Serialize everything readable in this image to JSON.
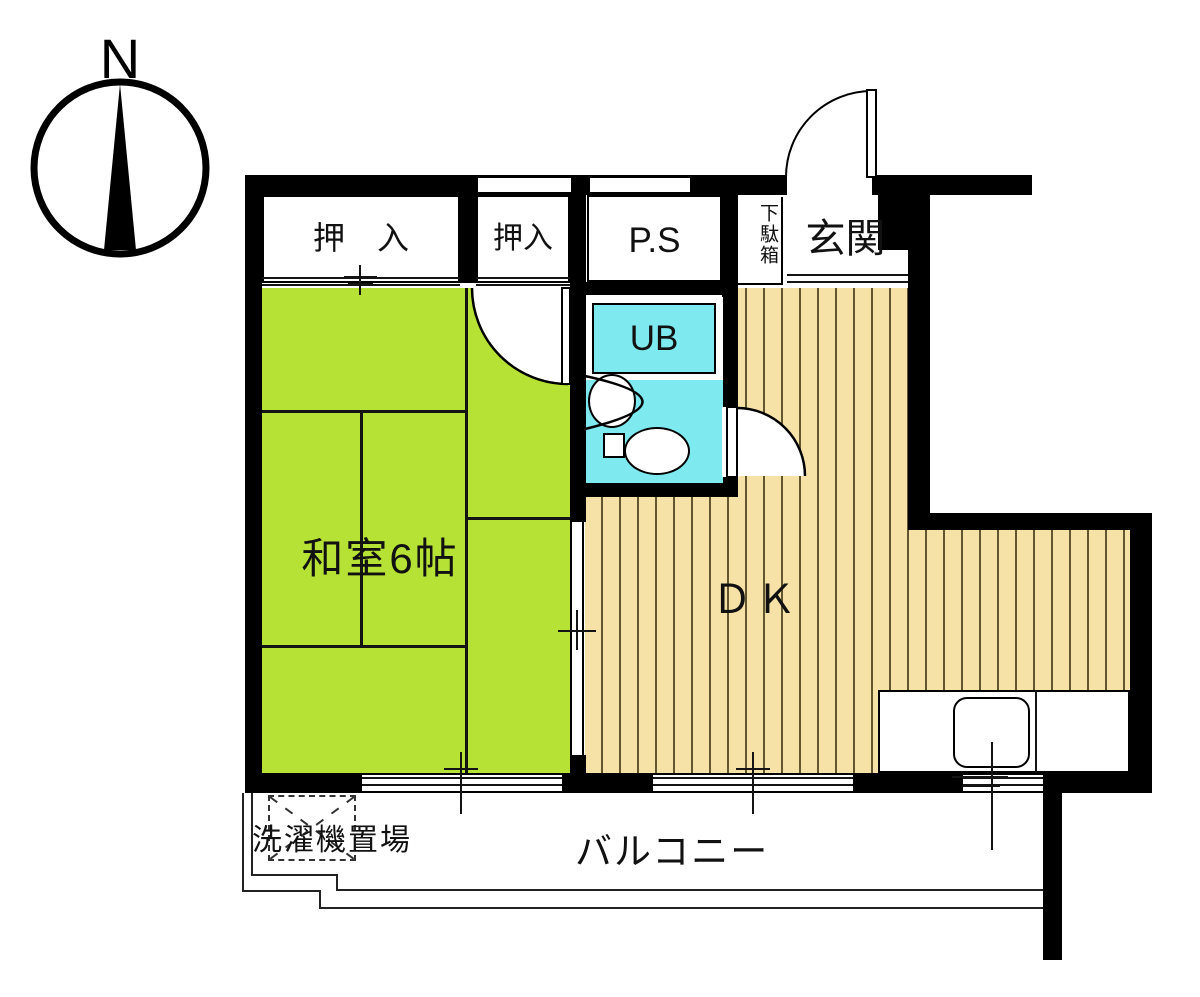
{
  "compass": {
    "label": "N"
  },
  "rooms": {
    "japanese_room": {
      "label": "和室6帖"
    },
    "dining_kitchen": {
      "label": "ＤＫ"
    },
    "closet_wide": {
      "label": "押　入"
    },
    "closet_small": {
      "label": "押入"
    },
    "pipe_space": {
      "label": "P.S"
    },
    "shoe_cabinet": {
      "label": "下駄箱"
    },
    "entrance": {
      "label": "玄関"
    },
    "unit_bath": {
      "label": "UB"
    }
  },
  "balcony": {
    "label": "バルコニー",
    "washing_machine_label": "洗濯機置場"
  },
  "colors": {
    "tatami_green": "#b6e235",
    "floor_tan": "#f6e2a6",
    "bath_cyan": "#7fe9f0",
    "wall_black": "#000000"
  }
}
